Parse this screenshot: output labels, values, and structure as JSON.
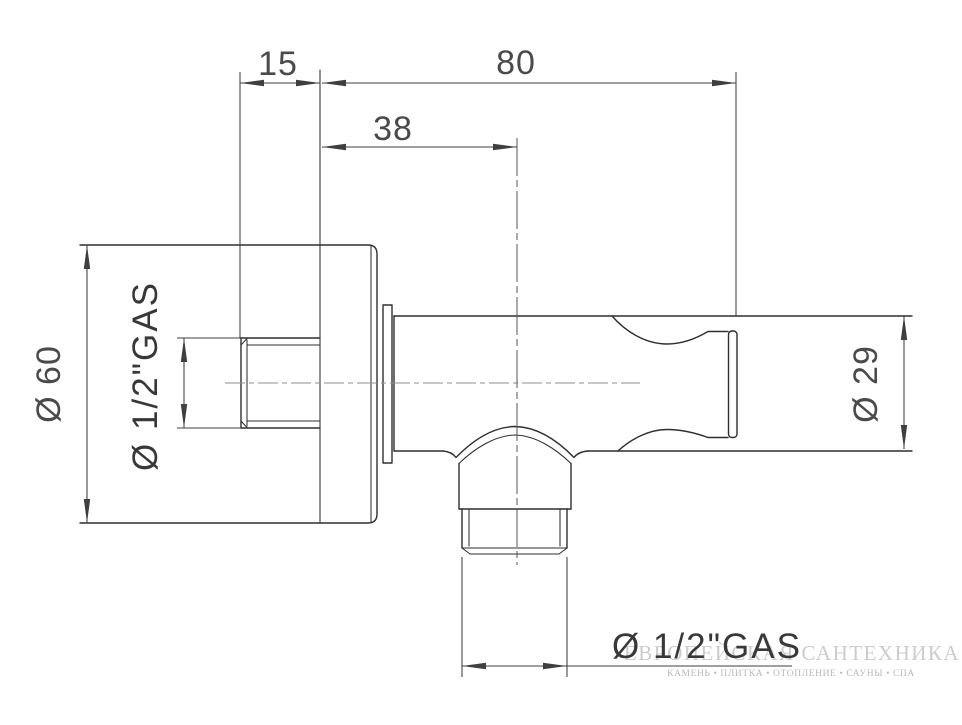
{
  "drawing": {
    "description": "Side-view technical drawing of a wall shower outlet elbow with escutcheon and downward threaded outlet"
  },
  "labels": {
    "dim_15": "15",
    "dim_80": "80",
    "dim_38": "38",
    "dia_60": "Ø 60",
    "thread_left": "Ø 1/2\"GAS",
    "dia_29": "Ø 29",
    "thread_bottom": "Ø 1/2\"GAS"
  },
  "watermark": {
    "title": "ЕВРОПЕЙСКАЯ САНТЕХНИКА",
    "subtitle": "КАМЕНЬ • ПЛИТКА • ОТОПЛЕНИЕ • САУНЫ • СПА"
  },
  "colors": {
    "background": "#ffffff",
    "line": "#2f2f2f",
    "dim": "#3f3f3f",
    "text": "#4a4a4a",
    "watermark_title": "#cccccc",
    "watermark_subtitle": "#b9b9b9"
  }
}
